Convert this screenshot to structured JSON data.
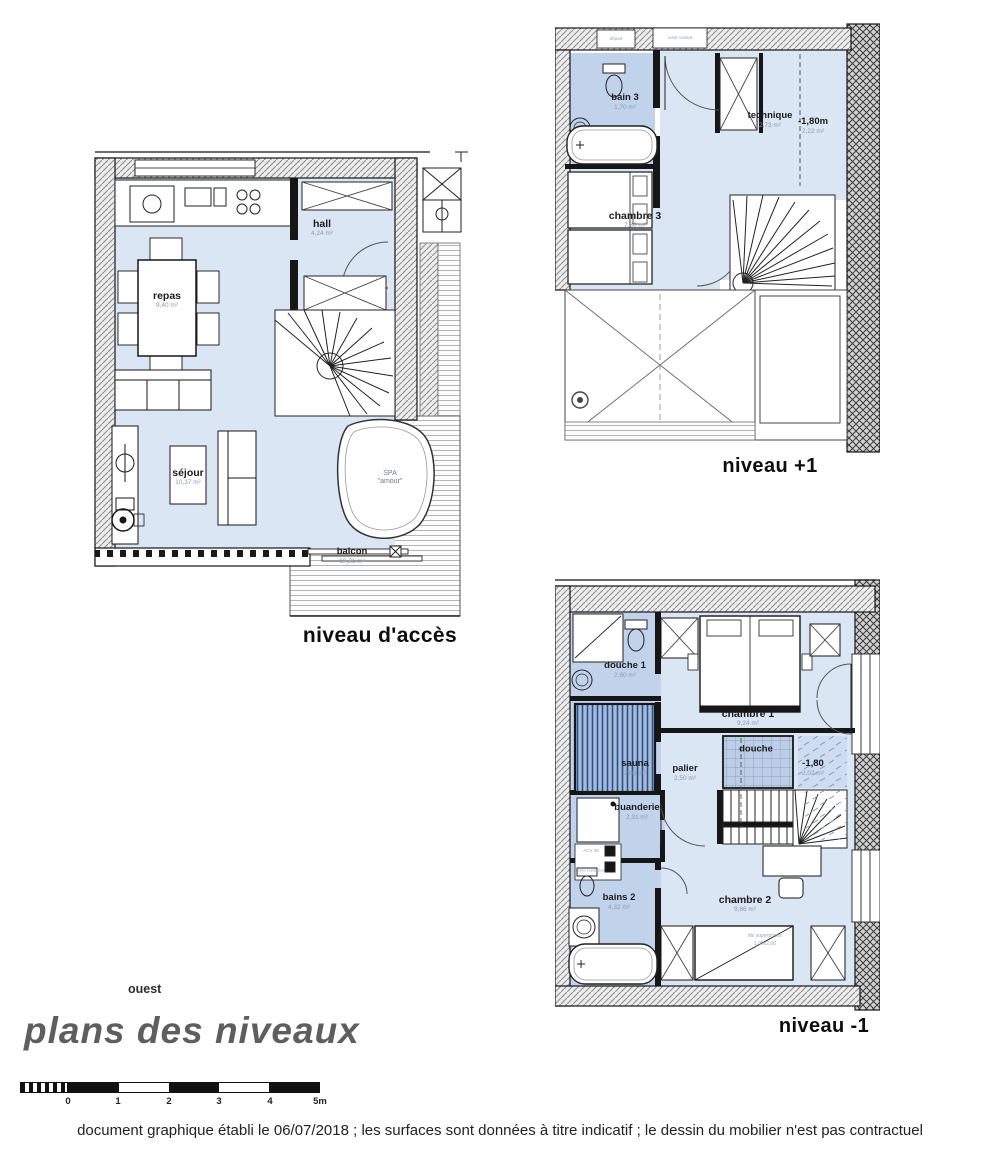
{
  "sheet": {
    "orientation_label": "ouest",
    "title": "plans des niveaux",
    "footer": "document graphique établi le 06/07/2018 ; les surfaces sont données à titre indicatif ; le dessin du mobilier n'est pas contractuel"
  },
  "scalebar": {
    "ticks": [
      "0",
      "1",
      "2",
      "3",
      "4",
      "5m"
    ]
  },
  "plans": {
    "acces": {
      "caption": "niveau d'accès",
      "rooms": {
        "repas": {
          "name": "repas",
          "area": "9,40 m²"
        },
        "hall": {
          "name": "hall",
          "area": "4,24 m²"
        },
        "sejour": {
          "name": "séjour",
          "area": "10,37 m²"
        },
        "balcon": {
          "name": "balcon",
          "area": "19,81 m²"
        },
        "spa": {
          "name": "SPA",
          "sub": "\"amour\""
        }
      }
    },
    "plus1": {
      "caption": "niveau +1",
      "annotations": {
        "box1": "départ",
        "box2": "volet roulant"
      },
      "rooms": {
        "bain3": {
          "name": "bain 3",
          "area": "1,70 m²"
        },
        "technique": {
          "name": "technique",
          "area": "2,73 m²"
        },
        "souspente": {
          "name": "-1,80m",
          "area": "2,22 m²"
        },
        "chambre3": {
          "name": "chambre 3",
          "area": "7,36 m²"
        }
      }
    },
    "moins1": {
      "caption": "niveau -1",
      "annotations": {
        "acv": "ACV 38",
        "vase": "vase expansion",
        "bunk1": "lits superposés",
        "bunk2": "1,00x2,00"
      },
      "rooms": {
        "douche1": {
          "name": "douche 1",
          "area": "2,80 m²"
        },
        "chambre1": {
          "name": "chambre 1",
          "area": "9,24 m²"
        },
        "sauna": {
          "name": "sauna",
          "area": "2,83 m²"
        },
        "palier": {
          "name": "palier",
          "area": "2,50 m²"
        },
        "douche": {
          "name": "douche",
          "area": ""
        },
        "souspente": {
          "name": "-1,80",
          "area": "2,02 m²"
        },
        "buanderie": {
          "name": "buanderie",
          "area": "2,31 m²"
        },
        "bains2": {
          "name": "bains 2",
          "area": "4,32 m²"
        },
        "chambre2": {
          "name": "chambre 2",
          "area": "9,86 m²"
        }
      }
    }
  }
}
